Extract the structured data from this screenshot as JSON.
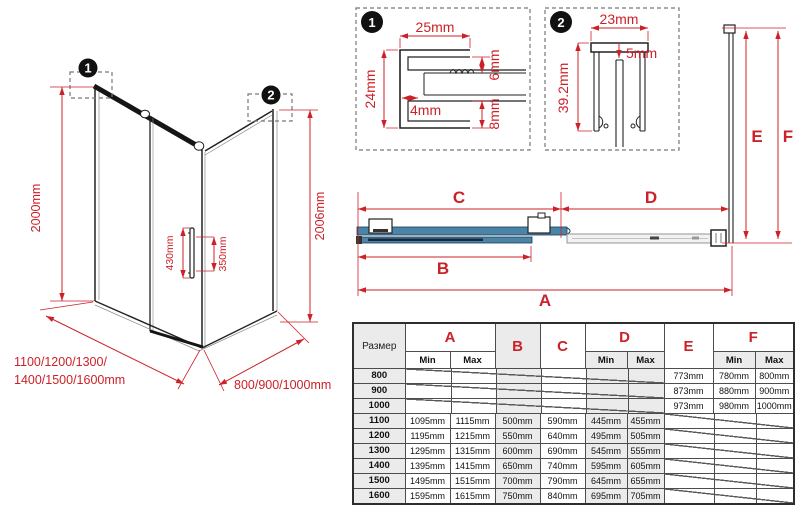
{
  "dims": {
    "a": "A",
    "b": "B",
    "c": "C",
    "d": "D",
    "e": "E",
    "f": "F"
  },
  "perspective": {
    "callout1": "1",
    "callout2": "2",
    "height_left": "2000mm",
    "height_right": "2006mm",
    "handle_outer": "430mm",
    "handle_inner": "350mm",
    "width_line1": "1100/1200/1300/",
    "width_line2": "1400/1500/1600mm",
    "depth": "800/900/1000mm"
  },
  "detail1": {
    "num": "1",
    "top": "25mm",
    "left": "24mm",
    "lip": "4mm",
    "upper_right": "6mm",
    "lower_right": "8mm"
  },
  "detail2": {
    "num": "2",
    "top": "23mm",
    "inset": "5mm",
    "left": "39.2mm"
  },
  "table": {
    "size_header": "Размер",
    "min_label": "Min",
    "max_label": "Max",
    "rows": [
      {
        "size": "800",
        "e": "773mm",
        "f_min": "780mm",
        "f_max": "800mm"
      },
      {
        "size": "900",
        "e": "873mm",
        "f_min": "880mm",
        "f_max": "900mm"
      },
      {
        "size": "1000",
        "e": "973mm",
        "f_min": "980mm",
        "f_max": "1000mm"
      },
      {
        "size": "1100",
        "a_min": "1095mm",
        "a_max": "1115mm",
        "b": "500mm",
        "c": "590mm",
        "d_min": "445mm",
        "d_max": "455mm"
      },
      {
        "size": "1200",
        "a_min": "1195mm",
        "a_max": "1215mm",
        "b": "550mm",
        "c": "640mm",
        "d_min": "495mm",
        "d_max": "505mm"
      },
      {
        "size": "1300",
        "a_min": "1295mm",
        "a_max": "1315mm",
        "b": "600mm",
        "c": "690mm",
        "d_min": "545mm",
        "d_max": "555mm"
      },
      {
        "size": "1400",
        "a_min": "1395mm",
        "a_max": "1415mm",
        "b": "650mm",
        "c": "740mm",
        "d_min": "595mm",
        "d_max": "605mm"
      },
      {
        "size": "1500",
        "a_min": "1495mm",
        "a_max": "1515mm",
        "b": "700mm",
        "c": "790mm",
        "d_min": "645mm",
        "d_max": "655mm"
      },
      {
        "size": "1600",
        "a_min": "1595mm",
        "a_max": "1615mm",
        "b": "750mm",
        "c": "840mm",
        "d_min": "695mm",
        "d_max": "705mm"
      }
    ]
  },
  "colors": {
    "dimension_red": "#cc2128",
    "glass_blue": "#4a85a8",
    "table_shade": "#ebebeb",
    "line_black": "#222222"
  }
}
